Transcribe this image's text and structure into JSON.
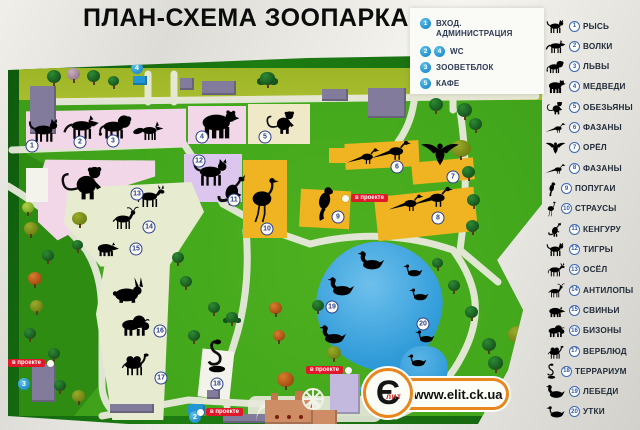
{
  "title": "ПЛАН-СХЕМА ЗООПАРКА",
  "facilities_legend": {
    "items": [
      {
        "nums": [
          "1"
        ],
        "label": "ВХОД. АДМИНИСТРАЦИЯ"
      },
      {
        "nums": [
          "2",
          "4"
        ],
        "label": "WC"
      },
      {
        "nums": [
          "3"
        ],
        "label": "ЗООВЕТБЛОК"
      },
      {
        "nums": [
          "5"
        ],
        "label": "КАФЕ"
      }
    ]
  },
  "animals_legend": {
    "items": [
      {
        "num": "1",
        "label": "РЫСЬ",
        "icon": "lynx-icon"
      },
      {
        "num": "2",
        "label": "ВОЛКИ",
        "icon": "wolf-icon"
      },
      {
        "num": "3",
        "label": "ЛЬВЫ",
        "icon": "lion-icon"
      },
      {
        "num": "4",
        "label": "МЕДВЕДИ",
        "icon": "bear-icon"
      },
      {
        "num": "5",
        "label": "ОБЕЗЬЯНЫ",
        "icon": "monkey-icon"
      },
      {
        "num": "6",
        "label": "ФАЗАНЫ",
        "icon": "pheasant-icon"
      },
      {
        "num": "7",
        "label": "ОРЁЛ",
        "icon": "eagle-icon"
      },
      {
        "num": "8",
        "label": "ФАЗАНЫ",
        "icon": "pheasant-icon"
      },
      {
        "num": "9",
        "label": "ПОПУГАИ",
        "icon": "parrot-icon"
      },
      {
        "num": "10",
        "label": "СТРАУСЫ",
        "icon": "ostrich-icon"
      },
      {
        "num": "11",
        "label": "КЕНГУРУ",
        "icon": "kangaroo-icon"
      },
      {
        "num": "12",
        "label": "ТИГРЫ",
        "icon": "tiger-icon"
      },
      {
        "num": "13",
        "label": "ОСЁЛ",
        "icon": "donkey-icon"
      },
      {
        "num": "14",
        "label": "АНТИЛОПЫ",
        "icon": "antelope-icon"
      },
      {
        "num": "15",
        "label": "СВИНЬИ",
        "icon": "pig-icon"
      },
      {
        "num": "16",
        "label": "БИЗОНЫ",
        "icon": "bison-icon"
      },
      {
        "num": "17",
        "label": "ВЕРБЛЮД",
        "icon": "camel-icon"
      },
      {
        "num": "18",
        "label": "ТЕРРАРИУМ",
        "icon": "snake-icon"
      },
      {
        "num": "19",
        "label": "ЛЕБЕДИ",
        "icon": "swan-icon"
      },
      {
        "num": "20",
        "label": "УТКИ",
        "icon": "duck-icon"
      }
    ]
  },
  "map": {
    "project_label": "в проекте",
    "facility_markers": [
      {
        "num": "4"
      },
      {
        "num": "3"
      },
      {
        "num": "2"
      },
      {
        "num": "5"
      }
    ]
  },
  "watermark": {
    "url": "www.elit.ck.ua",
    "logo_letter": "Є",
    "logo_sub": "лит"
  },
  "colors": {
    "field_green": "#43a71c",
    "pond_blue": "#2e9ad8",
    "accent_red": "#e0182a",
    "marker_blue": "#1f8ec9",
    "enclosure_pink": "#f2d7e8",
    "enclosure_orange": "#f0b321",
    "enclosure_cream": "#efe9c8",
    "enclosure_lavender": "#dcc6ee"
  }
}
